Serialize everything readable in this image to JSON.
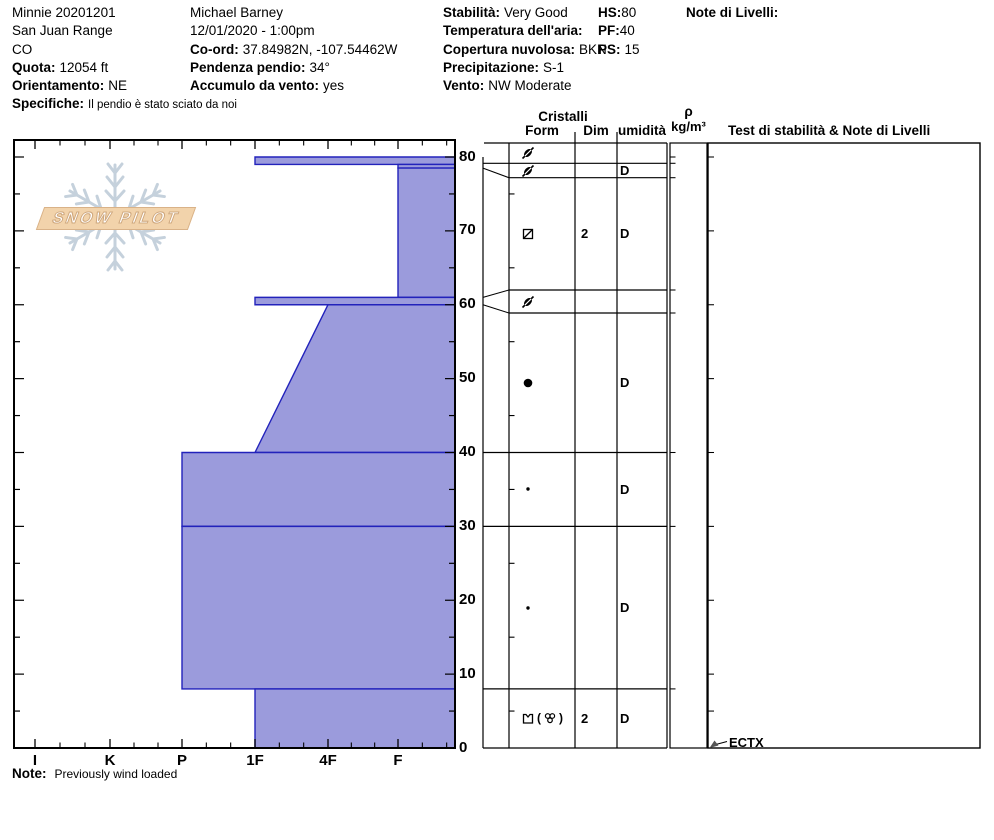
{
  "header": {
    "col1": {
      "title": "Minnie 20201201",
      "range": "San Juan Range",
      "state": "CO",
      "quota_label": "Quota:",
      "quota_value": "12054 ft",
      "orient_label": "Orientamento:",
      "orient_value": "NE",
      "spec_label": "Specifiche:",
      "spec_value": "Il pendio è stato sciato da noi"
    },
    "col2": {
      "observer": "Michael Barney",
      "datetime": "12/01/2020 - 1:00pm",
      "coord_label": "Co-ord:",
      "coord_value": "37.84982N, -107.54462W",
      "slope_label": "Pendenza pendio:",
      "slope_value": "34°",
      "windload_label": "Accumulo da vento:",
      "windload_value": "yes"
    },
    "col3": {
      "stab_label": "Stabilità:",
      "stab_value": "Very Good",
      "airtemp_label": "Temperatura dell'aria:",
      "airtemp_value": "",
      "cloud_label": "Copertura nuvolosa:",
      "cloud_value": "BKN",
      "precip_label": "Precipitazione:",
      "precip_value": "S-1",
      "wind_label": "Vento:",
      "wind_value": "NW Moderate"
    },
    "col4": {
      "hs_label": "HS:",
      "hs_value": "80",
      "pf_label": "PF:",
      "pf_value": "40",
      "ps_label": "PS:",
      "ps_value": "15"
    },
    "col5": {
      "notes_label": "Note di Livelli:"
    }
  },
  "logo": {
    "text": "SNOW PILOT"
  },
  "table_headers": {
    "cristalli": "Cristalli",
    "form": "Form",
    "dim": "Dim",
    "umidita": "umidità",
    "rho": "ρ",
    "rho_units": "kg/m³",
    "test": "Test di stabilità & Note di Livelli"
  },
  "test_annotation": "ECTX",
  "footer": {
    "note_label": "Note:",
    "note_value": "Previously wind loaded"
  },
  "chart_data": {
    "type": "snow-profile",
    "title": "Snow pit hardness profile",
    "hardness_axis": {
      "categories": [
        "I",
        "K",
        "P",
        "1F",
        "4F",
        "F"
      ],
      "x_px": [
        35,
        110,
        182,
        255,
        328,
        398
      ],
      "plot_left_px": 14,
      "plot_right_px": 455,
      "plot_top_px": 140,
      "plot_bottom_px": 748
    },
    "depth_axis": {
      "unit": "cm",
      "tick_labels": [
        0,
        10,
        20,
        30,
        40,
        50,
        60,
        70,
        80
      ],
      "minor_step": 5,
      "ground_px": 748,
      "px_per_cm": 7.3875,
      "label_x_px": 459
    },
    "colors": {
      "layer_fill": "#9b9bdc",
      "layer_stroke": "#2222bb",
      "axis": "#000000",
      "logo_tan": "#d9b288",
      "logo_flake": "#c5d1dc"
    },
    "layers": [
      {
        "top": 80,
        "bottom": 79,
        "hardness": "1F",
        "grain": "DF",
        "dim": "",
        "moisture": "",
        "row": [
          143,
          163.3
        ]
      },
      {
        "top": 79,
        "bottom": 78.5,
        "hardness": "F",
        "grain": "DF",
        "dim": "",
        "moisture": "D",
        "row": [
          163.3,
          177.7
        ]
      },
      {
        "top": 78.5,
        "bottom": 61,
        "hardness": "F",
        "grain": "FC_slash",
        "dim": "2",
        "moisture": "D",
        "row": [
          177.7,
          290
        ]
      },
      {
        "top": 61,
        "bottom": 60,
        "hardness": "1F",
        "grain": "DF",
        "dim": "",
        "moisture": "",
        "row": [
          290,
          313
        ]
      },
      {
        "top": 60,
        "bottom": 40,
        "hardness": "4F",
        "hardness_bottom": "1F",
        "grain": "RG",
        "dim": "",
        "moisture": "D",
        "row": [
          313,
          452.5
        ]
      },
      {
        "top": 40,
        "bottom": 30,
        "hardness": "P",
        "grain": "RG_small",
        "dim": "",
        "moisture": "D",
        "row": [
          452.5,
          526.4
        ]
      },
      {
        "top": 30,
        "bottom": 8,
        "hardness": "P",
        "grain": "RG_small",
        "dim": "",
        "moisture": "D",
        "row": [
          526.4,
          688.9
        ]
      },
      {
        "top": 8,
        "bottom": 0,
        "hardness": "1F",
        "grain": "FCxr_MFcl",
        "dim": "2",
        "moisture": "D",
        "row": [
          688.9,
          748
        ]
      }
    ],
    "table_geometry": {
      "flag_col_left": 483,
      "form_col_left": 509,
      "dim_col_left": 575,
      "umid_col_left": 617,
      "table_right": 667,
      "rho_left": 670,
      "rho_right": 707,
      "test_left": 708,
      "test_right": 980,
      "top": 143,
      "bottom": 748
    },
    "form_col_tick_depths": [
      75,
      65,
      55,
      45,
      35,
      25,
      15,
      5
    ],
    "rho_right_tick_depths": [
      80,
      70,
      60,
      50,
      40,
      30,
      20,
      10,
      5
    ],
    "tests": [
      {
        "label": "ECTX",
        "depth": 0
      }
    ]
  }
}
